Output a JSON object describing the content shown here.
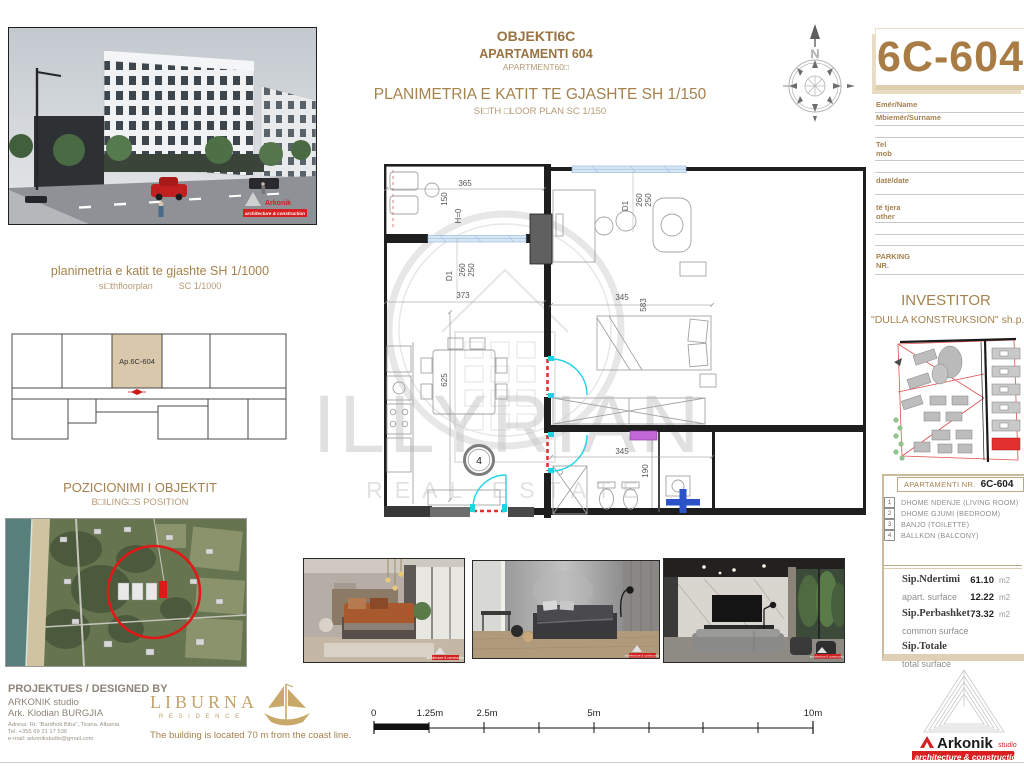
{
  "colors": {
    "accent": "#a5824e",
    "accent_light": "#b59a76",
    "brand_red": "#d82525",
    "tan_border": "#cabb9c",
    "cyan": "#22d3e6",
    "window_blue": "#d7e6f4"
  },
  "header": {
    "project": "OBJEKTI6C",
    "apartment": "APARTAMENTI 604",
    "apartment_en": "APARTMENT60□",
    "plan_title": "PLANIMETRIA E KATIT TE GJASHTE SH 1/150",
    "plan_subtitle": "SI□TH □LOOR PLAN SC 1/150",
    "unit_code": "6C-604",
    "compass_n": "N"
  },
  "form": {
    "name": "Emër/Name",
    "surname": "Mbiemër/Surname",
    "tel": "Tel",
    "mob": "mob",
    "date": "datë/date",
    "other_sq": "të tjera",
    "other_en": "other",
    "parking": "PARKING",
    "parking_nr": "NR."
  },
  "investor": {
    "title": "INVESTITOR",
    "company": "\"DULLA KONSTRUKSION\" sh.p.k"
  },
  "key_plan": {
    "title": "planimetria e katit te gjashte SH 1/1000",
    "subtitle": "si□thfloorplan",
    "scale": "SC 1/1000",
    "unit_label": "Ap.6C-604"
  },
  "position": {
    "title": "POZICIONIMI I OBJEKTIT",
    "subtitle": "B□ILING□S POSITION"
  },
  "legend": {
    "header_label": "APARTAMENTI NR.",
    "header_code": "6C-604",
    "rooms": [
      {
        "num": "1",
        "label": "DHOME NDENJE (LIVING ROOM)"
      },
      {
        "num": "2",
        "label": "DHOME GJUMI (BEDROOM)"
      },
      {
        "num": "3",
        "label": "BANJO (TOILETTE)"
      },
      {
        "num": "4",
        "label": "BALLKON (BALCONY)"
      }
    ],
    "surfaces": [
      {
        "label": "Sip.Ndertimi",
        "value": "61.10",
        "unit": "m2"
      },
      {
        "label": "apart. surface",
        "value": "12.22",
        "unit": "m2"
      },
      {
        "label": "Sip.Perbashket",
        "value": "73.32",
        "unit": "m2"
      },
      {
        "label": "common surface",
        "value": "",
        "unit": ""
      },
      {
        "label": "Sip.Totale",
        "value": "",
        "unit": ""
      },
      {
        "label": "total surface",
        "value": "",
        "unit": ""
      }
    ]
  },
  "plan": {
    "dims": {
      "balcony_w": "365",
      "balcony_d": "150",
      "h0": "H=0",
      "door_left": "D1",
      "door_left_a": "260",
      "door_left_b": "250",
      "door_right": "D1",
      "door_right_a": "260",
      "door_right_b": "250",
      "living_w": "373",
      "bed_w": "345",
      "bed_h": "583",
      "living_h": "625",
      "bath_w": "345",
      "bath_h": "190",
      "room_no": "4"
    }
  },
  "watermark": {
    "line1": "ILLYRIAN",
    "line2": "REAL ESTATE"
  },
  "designer": {
    "title": "PROJEKTUES / DESIGNED BY",
    "studio": "ARKONIK studio",
    "architect": "Ark. Klodian BURGJIA",
    "address": "Adresa: Rr. \"Bardhok Biba\", Tirana, Albania.",
    "tel": "Tel. +355 69 21 17 536",
    "email": "e-mail: arkonikstudio@gmail.com"
  },
  "liburna": {
    "name": "LIBURNA",
    "subtitle": "R E S I D E N C E",
    "note": "The building is located 70 m from the coast line."
  },
  "scalebar": {
    "labels": [
      "0",
      "1.25m",
      "2.5m",
      "5m",
      "10m"
    ]
  },
  "arkonik": {
    "name": "Arkonik",
    "studio": "studio",
    "tagline": "architecture & construction"
  }
}
